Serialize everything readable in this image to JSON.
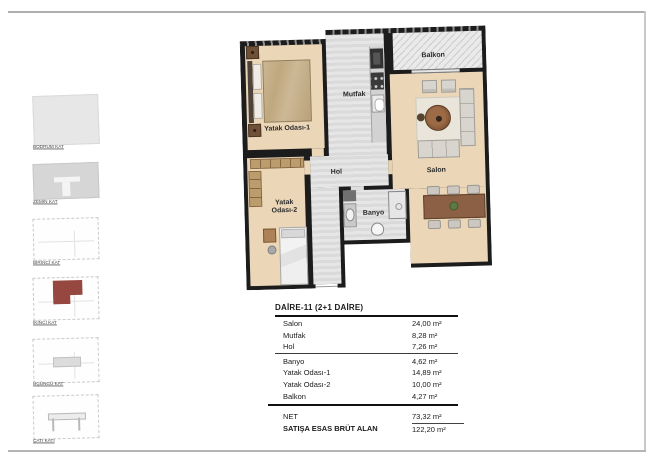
{
  "sidebar": {
    "floors": [
      {
        "id": "bodrum",
        "label": "BODRUM KAT"
      },
      {
        "id": "zemin",
        "label": "ZEMİN KAT"
      },
      {
        "id": "birinci",
        "label": "BİRİNCİ KAT"
      },
      {
        "id": "ikinci",
        "label": "İKİNCİ KAT",
        "highlighted": true
      },
      {
        "id": "ucuncu",
        "label": "ÜÇÜNCÜ KAT"
      },
      {
        "id": "cati",
        "label": "ÇATI KATI"
      }
    ]
  },
  "plan": {
    "rooms": {
      "yatak1": "Yatak Odası-1",
      "mutfak": "Mutfak",
      "balkon": "Balkon",
      "salon": "Salon",
      "hol": "Hol",
      "banyo": "Banyo",
      "yatak2": "Yatak Odası-2"
    }
  },
  "area_table": {
    "title": "DAİRE-11  (2+1 DAİRE)",
    "rows": [
      {
        "label": "Salon",
        "value": "24,00 m²"
      },
      {
        "label": "Mutfak",
        "value": "8,28 m²"
      },
      {
        "label": "Hol",
        "value": "7,26 m²"
      },
      {
        "label": "Banyo",
        "value": "4,62 m²"
      },
      {
        "label": "Yatak Odası-1",
        "value": "14,89 m²"
      },
      {
        "label": "Yatak Odası-2",
        "value": "10,00 m²"
      },
      {
        "label": "Balkon",
        "value": "4,27 m²"
      }
    ],
    "net": {
      "label": "NET",
      "value": "73,32 m²"
    },
    "brut": {
      "label": "SATIŞA ESAS BRÜT ALAN",
      "value": "122,20 m²"
    }
  },
  "colors": {
    "highlight_red": "#96473f",
    "wall_black": "#1c1c1c",
    "floor_beige": "#ebd7b8",
    "wet_floor_gray": "#dedede",
    "frame_gray": "#b0b0b0"
  }
}
